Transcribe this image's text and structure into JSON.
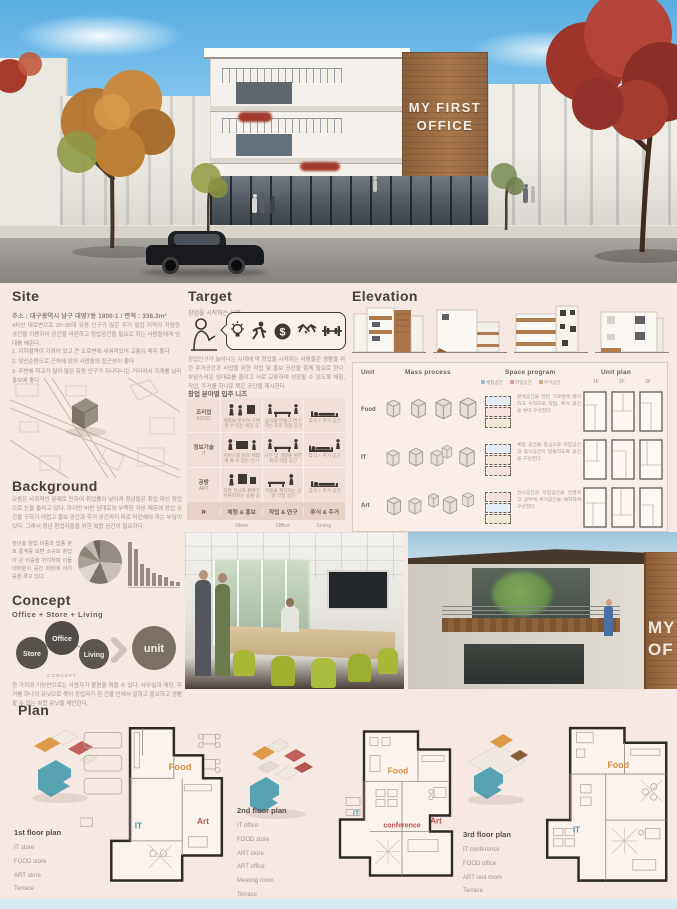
{
  "hero": {
    "sign_line1": "MY FIRST",
    "sign_line2": "OFFICE",
    "sign_band": "OFFICE & SHOP"
  },
  "site": {
    "title": "Site",
    "address": "주소 : 대구광역시 남구 대명7동 1800-1  /  면적 : 336.3m²",
    "body": "4차선 대로변으로 20~30대 유동 인구가 많은 주거 밀집 지역의 저렴한 공간을 이용하여 공간을 마련하고 창업공간을 필요로 하는 사람들에게 임대를 해준다.",
    "notes": [
      "1. 지하철역이 가까이 있고 큰 도로변에 세워져있어 교통이 매우 좋다",
      "2. 앞산순환도로 근처에 있어 사람들의 접근성이 좋다",
      "3. 주변에 학교가 많아 많은 유동 인구가 지나다니는 거리여서 가게를 널리 홍보에 좋다"
    ]
  },
  "target": {
    "title": "Target",
    "subtitle": "창업을 시작하는 사람",
    "body": "창업인구가 늘어나는 시대에 막 창업을 시작하는 사람들은 생활을 위한 주거공간과 사업을 위한 작업 및 홍보 공간을 함께 필요로 한다. 부담스러운 임대료를 줄이고 서로 교류하며 성장할 수 있도록 체험, 작업, 주거를 하나로 묶은 공간을 제시한다.",
    "needs_title": "창업 분야별 입주 니즈",
    "rows": [
      {
        "category": "조리업",
        "code": "FOOD",
        "cells": [
          "제품을 맛보며 구매할 수 있는 매장 공간",
          "음식을 만들고 연구하는 조리 작업 공간",
          "휴식 + 주거 공간"
        ]
      },
      {
        "category": "정보기술",
        "code": "IT",
        "cells": [
          "서비스를 바로 체험해 볼 수 있는 전시 공간",
          "사무 및 개발을 위한 회의 작업 공간",
          "휴식 + 주거 공간"
        ]
      },
      {
        "category": "공방",
        "code": "ART",
        "cells": [
          "작품 전시와 판매가 이루어지는 쇼룸 공간",
          "작품을 제작하는 공방 작업 공간",
          "휴식 + 주거 공간"
        ]
      }
    ],
    "summary_arrow": "»",
    "summary_cells": [
      "체험 & 홍보",
      "작업 & 연구",
      "휴식 & 주거"
    ],
    "footer_cells": [
      "Store",
      "Office",
      "Living"
    ],
    "coin_glyph": "$"
  },
  "elevation": {
    "title": "Elevation"
  },
  "unit_table": {
    "headers": [
      "Unit",
      "Mass process",
      "Space program",
      "Unit plan"
    ],
    "legend": [
      "체험공간",
      "작업공간",
      "주거공간"
    ],
    "plan_cols": [
      "1F",
      "2F",
      "3F"
    ],
    "rows": [
      {
        "unit": "Food",
        "desc": "판매공간을 전면 가로변에 배치하고 수직으로 작업, 주거 공간을 쌓아 구성한다."
      },
      {
        "unit": "IT",
        "desc": "체험 공간을 중심으로 작업공간과 휴식공간이 맞물리도록 공간을 구성한다."
      },
      {
        "unit": "Art",
        "desc": "전시공간과 작업공간을 연결하고 상부에 주거공간을 배치하여 구성한다."
      }
    ]
  },
  "background": {
    "title": "Background",
    "body1": "요즘은 사회적인 문제로 인하여 취업률이 낮아져 청년들은 취업 대신 창업으로 눈을 돌리고 있다. 하지만 비싼 임대료와 부족한 자본 때문에 창업 공간을 구하기 어렵고 홍보 공간과 주거 공간까지 따로 마련해야 하는 부담이 있다. 그래서 청년 창업자들을 위한 복합 공간이 필요하다.",
    "body2": "청년층 창업 비중과 업종 분포 통계를 보면 소규모 창업이 큰 비중을 차지하며 이들 대부분이 공간 마련에 어려움을 겪고 있다."
  },
  "concept": {
    "title": "Concept",
    "formula": "Office + Store + Living",
    "circles": [
      "Store",
      "Office",
      "Living"
    ],
    "caption": "CONCEPT",
    "result": "unit",
    "body": "한 가지의 기능만으로는 사용자가 불편을 겪을 수 있다. 사무실과 매장, 주거를 하나의 유닛으로 묶어 창업자가 한 건물 안에서 일하고 홍보하고 생활할 수 있는 복합 유닛을 제안한다."
  },
  "plan": {
    "title": "Plan",
    "floors": [
      {
        "name": "1st floor plan",
        "items": [
          "IT store",
          "FOOD store",
          "ART store",
          "Terrace"
        ],
        "map_labels": {
          "food": "Food",
          "it": "IT",
          "art": "Art"
        }
      },
      {
        "name": "2nd floor plan",
        "items": [
          "IT office",
          "FOOD store",
          "ART store",
          "ART office",
          "Meeting room",
          "Terrace"
        ],
        "map_labels": {
          "food": "Food",
          "it": "IT",
          "art": "Art",
          "conference": "conference"
        }
      },
      {
        "name": "3rd floor plan",
        "items": [
          "IT conference",
          "FOOD office",
          "ART rest room",
          "Terrace"
        ],
        "map_labels": {
          "food": "Food",
          "it": "IT"
        }
      }
    ]
  },
  "photo_sign": {
    "line1": "MY",
    "line2": "OF"
  },
  "colors": {
    "board_bg": "#f6e8e2",
    "wood": "#a9774b",
    "dark": "#3e3833",
    "food_accent": "#d98f3e",
    "it_accent": "#4e9aaa",
    "art_accent": "#b9534f"
  },
  "chart_data": [
    {
      "type": "pie",
      "values": [
        26,
        18,
        14,
        12,
        10,
        8,
        7,
        5
      ],
      "title": ""
    },
    {
      "type": "bar",
      "values": [
        100,
        85,
        50,
        40,
        30,
        25,
        20,
        12,
        8
      ],
      "title": ""
    }
  ]
}
